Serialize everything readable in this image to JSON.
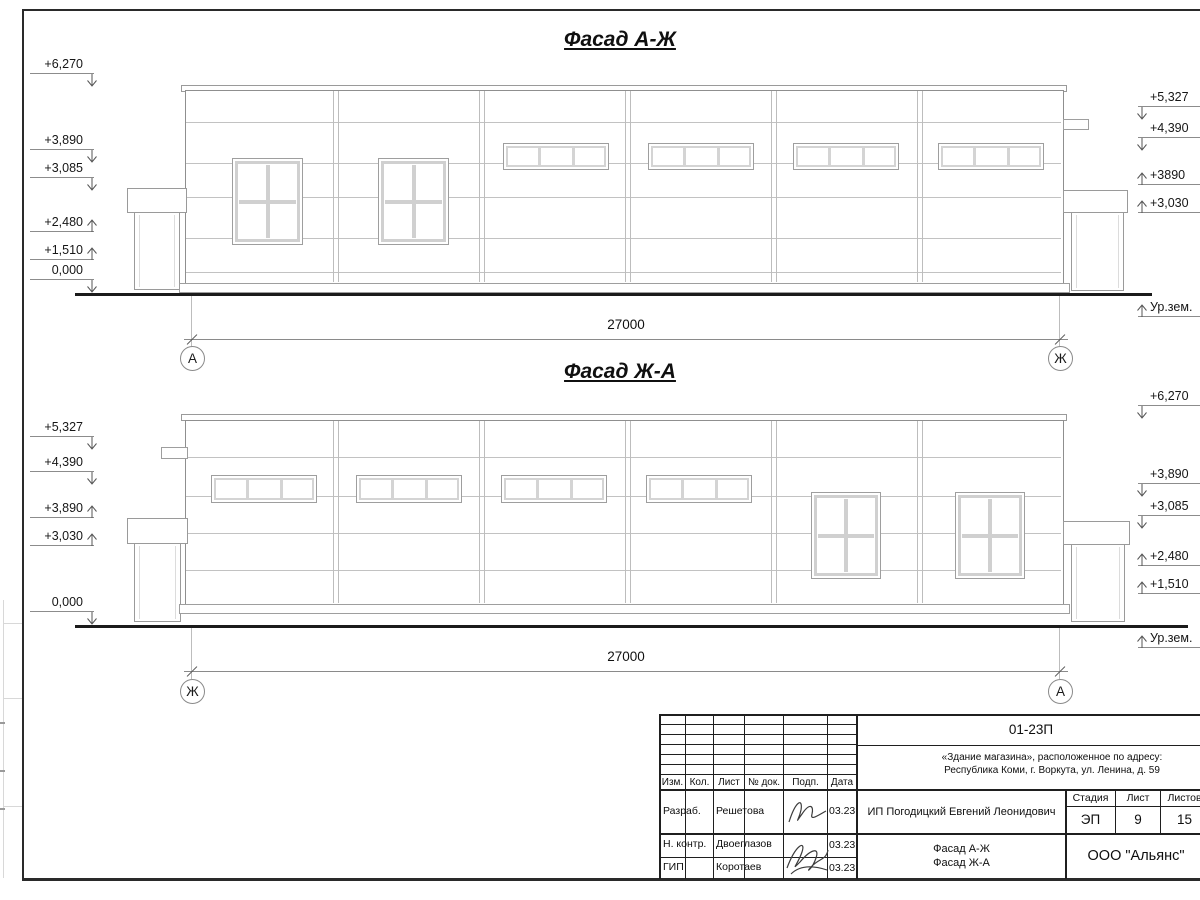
{
  "facade1": {
    "title": "Фасад А-Ж",
    "dim": "27000",
    "axis_left": "А",
    "axis_right": "Ж",
    "ground": "Ур.зем.",
    "left_marks": [
      "+6,270",
      "+3,890",
      "+3,085",
      "+2,480",
      "+1,510",
      "0,000"
    ],
    "right_marks": [
      "+5,327",
      "+4,390",
      "+3890",
      "+3,030"
    ]
  },
  "facade2": {
    "title": "Фасад Ж-А",
    "dim": "27000",
    "axis_left": "Ж",
    "axis_right": "А",
    "ground": "Ур.зем.",
    "left_marks": [
      "+5,327",
      "+4,390",
      "+3,890",
      "+3,030",
      "0,000"
    ],
    "right_marks": [
      "+6,270",
      "+3,890",
      "+3,085",
      "+2,480",
      "+1,510"
    ]
  },
  "titleblock": {
    "doc_number": "01-23П",
    "project_line1": "«Здание магазина», расположенное по адресу:",
    "project_line2": "Республика Коми, г. Воркута, ул. Ленина, д. 59",
    "client": "ИП Погодицкий Евгений Леонидович",
    "sheet_title_line1": "Фасад А-Ж",
    "sheet_title_line2": "Фасад Ж-А",
    "company": "ООО \"Альянс\"",
    "stage_label": "Стадия",
    "sheet_label": "Лист",
    "sheets_label": "Листов",
    "stage": "ЭП",
    "sheet": "9",
    "sheets": "15",
    "cols": {
      "izm": "Изм.",
      "kol": "Кол.",
      "list": "Лист",
      "doc": "№ док.",
      "podp": "Подп.",
      "data": "Дата"
    },
    "rows": [
      {
        "role": "Разраб.",
        "name": "Решетова",
        "date": "03.23"
      },
      {
        "role": "Н. контр.",
        "name": "Двоеглазов",
        "date": "03.23"
      },
      {
        "role": "ГИП",
        "name": "Коротаев",
        "date": "03.23"
      }
    ]
  }
}
